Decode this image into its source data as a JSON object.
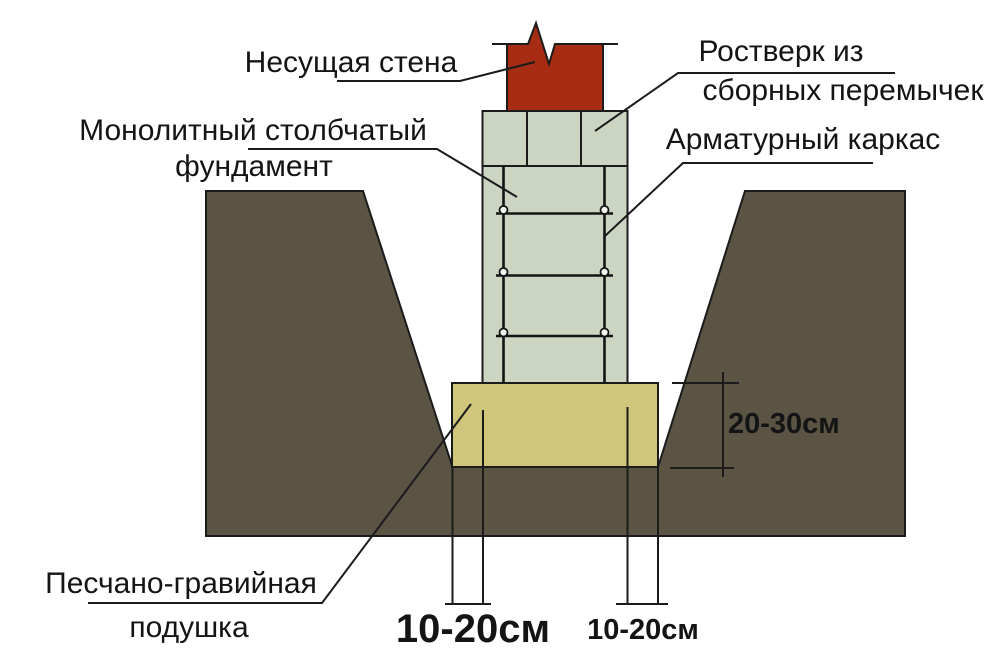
{
  "figure": {
    "title": "Монолитный столбчатый фундамент — схема",
    "colors": {
      "background": "#ffffff",
      "soil": "#5b5444",
      "pad": "#d0c67b",
      "concrete": "#ccd4c2",
      "brick": "#a62d14",
      "line": "#1b1b1b",
      "tie_fill": "#f2f4ee"
    },
    "labels": {
      "bearing_wall": "Несущая стена",
      "grillage_line1": "Ростверк из",
      "grillage_line2": "сборных перемычек",
      "foundation_line1": "Монолитный столбчатый",
      "foundation_line2": "фундамент",
      "rebar_cage": "Арматурный каркас",
      "cushion_line1": "Песчано-гравийная",
      "cushion_line2": "подушка"
    },
    "dimensions": {
      "pad_thickness": "20-30см",
      "left_offset": "10-20см",
      "right_offset": "10-20см"
    }
  }
}
